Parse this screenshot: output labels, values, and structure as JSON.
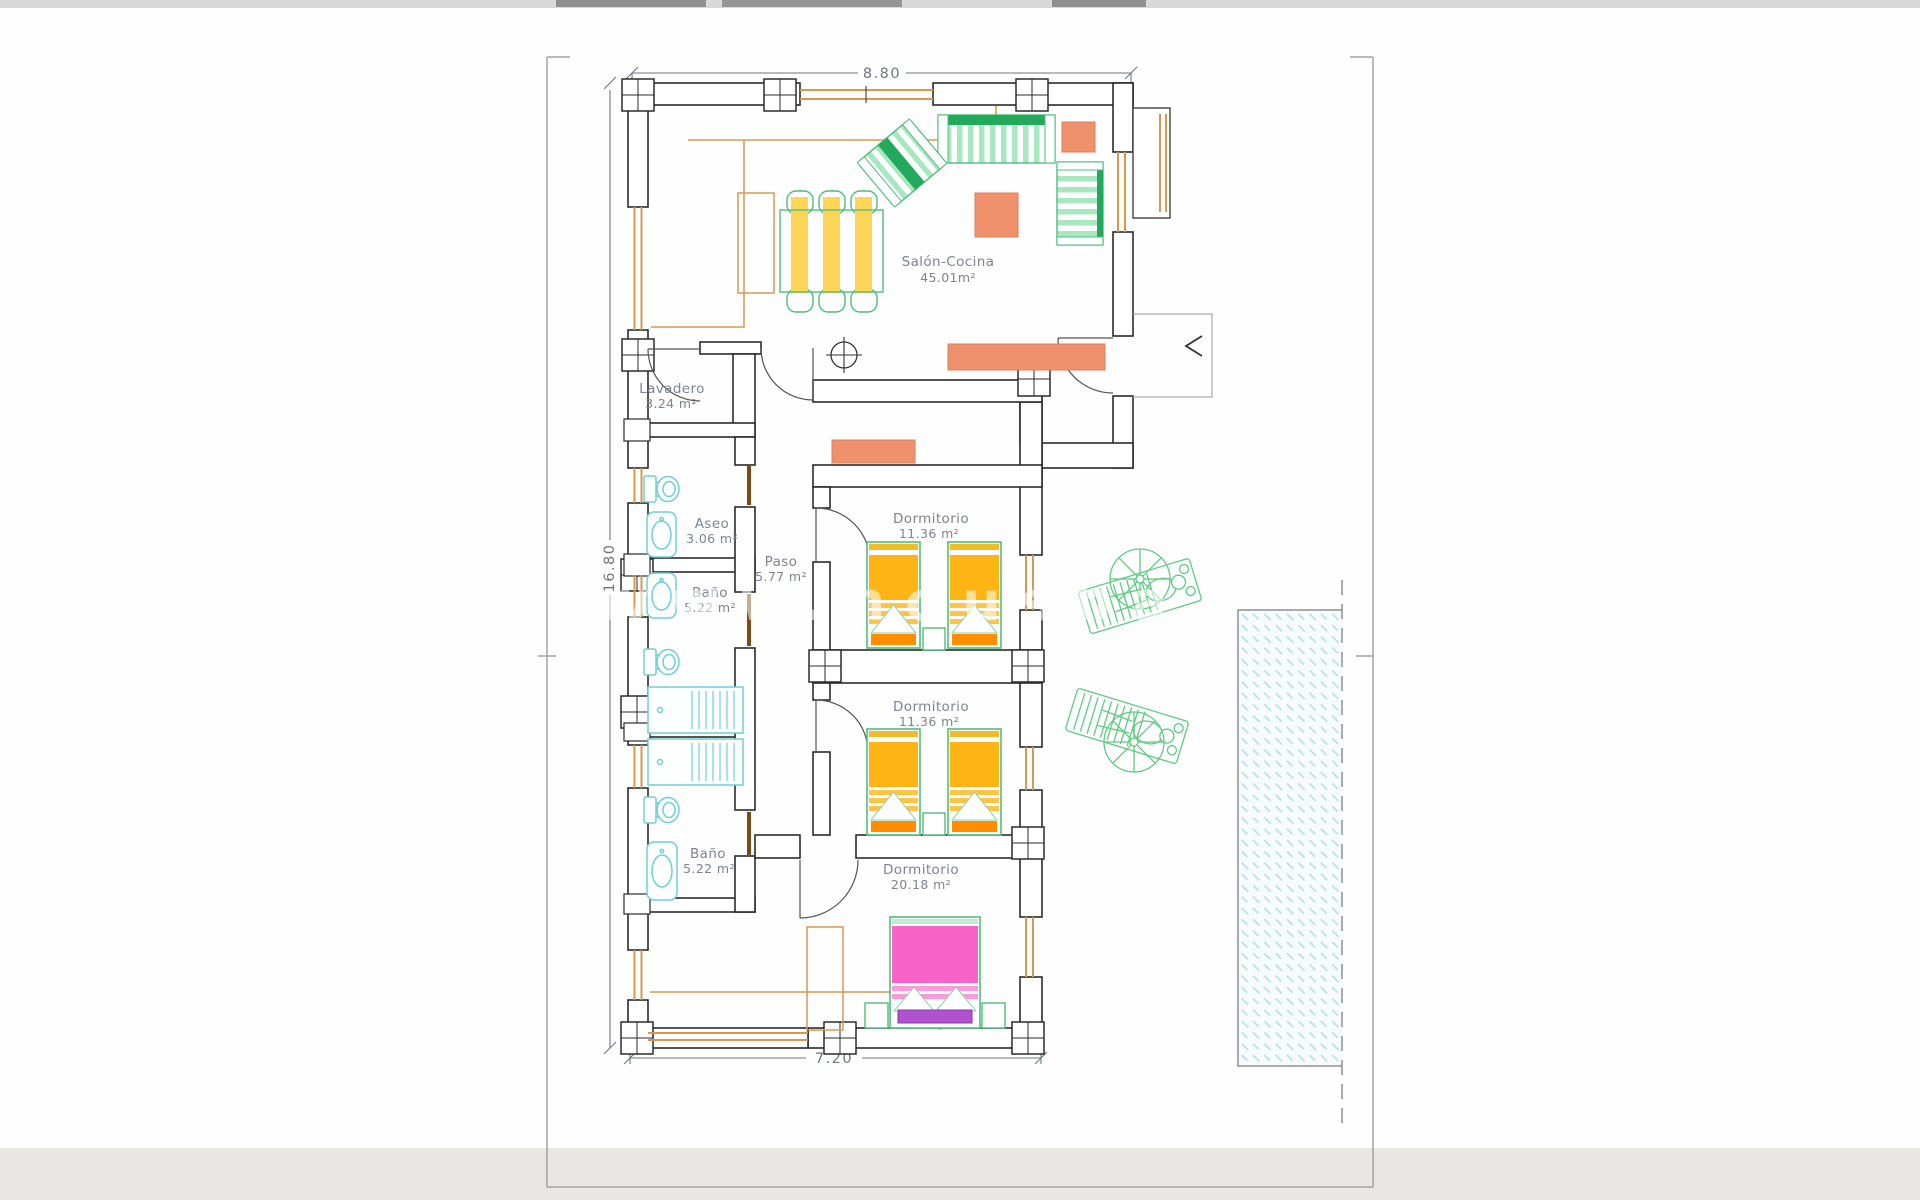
{
  "plan": {
    "type": "residential floor plan",
    "language": "es"
  },
  "dimensions": {
    "top_width_m": "8.80",
    "left_height_m": "16.80",
    "bottom_width_m": "7.20"
  },
  "rooms": {
    "salon": {
      "name": "Salón-Cocina",
      "area": "45.01m²"
    },
    "lavadero": {
      "name": "Lavadero",
      "area": "3.24 m²"
    },
    "aseo": {
      "name": "Aseo",
      "area": "3.06 m²"
    },
    "bano_top": {
      "name": "Baño",
      "area": "5.22 m²"
    },
    "paso": {
      "name": "Paso",
      "area": "5.77 m²"
    },
    "dormitorio1": {
      "name": "Dormitorio",
      "area": "11.36 m²"
    },
    "dormitorio2": {
      "name": "Dormitorio",
      "area": "11.36 m²"
    },
    "dormitorio3": {
      "name": "Dormitorio",
      "area": "20.18 m²"
    },
    "bano_bottom": {
      "name": "Baño",
      "area": "5.22 m²"
    }
  },
  "watermark": {
    "text": "www.nousha"
  },
  "colors": {
    "walls": "#2b2b2b",
    "property_boundary": "#a3a3a3",
    "dimension_text": "#6e7681",
    "room_label": "#7d8490",
    "wood_window_tan": "#d49a52",
    "furniture_green": "#4fbe7b",
    "furniture_green_dark": "#23a95c",
    "bed_yellow": "#ffb415",
    "bed_orange_footer": "#ff8d00",
    "salmon_tables": "#f0916e",
    "double_bed_pink": "#f763c6",
    "bench_purple": "#b052cf",
    "sanitary_cyan": "#70cfd6",
    "pool_hatch_cyan": "#b5dfe2"
  }
}
